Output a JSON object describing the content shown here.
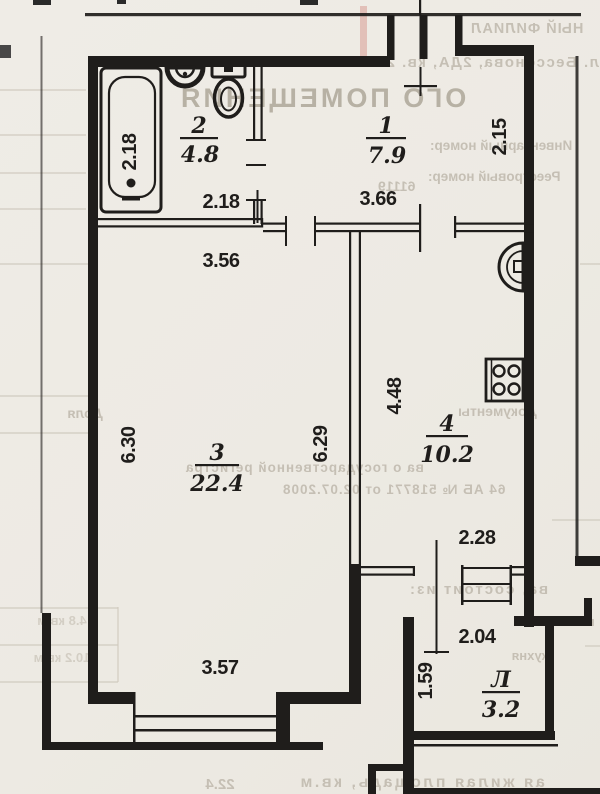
{
  "plan": {
    "rooms": {
      "bathroom": {
        "number": "2",
        "area": "4.8"
      },
      "hall": {
        "number": "1",
        "area": "7.9"
      },
      "living": {
        "number": "3",
        "area": "22.4"
      },
      "kitchen": {
        "number": "4",
        "area": "10.2"
      },
      "loggia": {
        "number": "Л",
        "area": "3.2"
      }
    },
    "dimensions": {
      "bathtub_length": "2.18",
      "bathroom_width": "2.18",
      "hall_width": "3.66",
      "niche_height": "2.15",
      "living_width_top": "3.56",
      "living_height": "6.30",
      "partition_height": "6.29",
      "kitchen_height": "4.48",
      "kitchen_width": "2.28",
      "living_width_bottom": "3.57",
      "loggia_width": "2.04",
      "loggia_depth": "1.59"
    },
    "fixtures": {
      "bathtub": "bathtub",
      "washbasin": "washbasin",
      "toilet": "toilet",
      "kitchen_sink": "kitchen-sink",
      "stove": "stove-4-burners"
    }
  },
  "bleed": {
    "branch": "НЫЙ ФИЛИАЛ",
    "address": "л. Бессонова, 2ДА, кв. 2",
    "title": "ОГО ПОМЕЩЕНИЯ",
    "inventory_label": "Инвентарный номер:",
    "registry_label": "Реестровый номер:",
    "registry_value": "61119",
    "col_share": "Доля",
    "col_documents": "Документы",
    "cert_line1": "ва о государственной регистра",
    "cert_line2": "64 АБ № 518771 от 02.07.2008",
    "consists": "ва, состоит из:",
    "word_bath": "ванной",
    "word_kitchen": "кухня",
    "area_row1": "4.8 кв.м",
    "area_row2": "10.2 кв.м",
    "footer_label": "ая жилая площадь, кв.м",
    "footer_value": "22.4"
  },
  "colors": {
    "ink": "#1f1d1b",
    "paper": "#edeae3",
    "bleed_text": "#bcb5a9"
  }
}
